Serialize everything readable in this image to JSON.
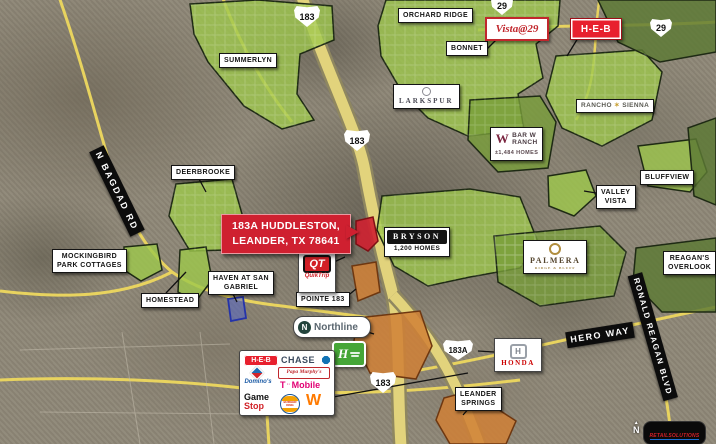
{
  "subject": {
    "line1": "183A HUDDLESTON,",
    "line2": "LEANDER, TX 78641"
  },
  "shields": {
    "s183_top": "183",
    "s183_mid": "183",
    "s183_bottom": "183",
    "s183a": "183A",
    "s29_left": "29",
    "s29_right": "29"
  },
  "communities": {
    "orchard_ridge": "ORCHARD RIDGE",
    "summerlyn": "SUMMERLYN",
    "bonnet": "BONNET",
    "larkspur": "LARKSPUR",
    "bar_w_ranch": {
      "monogram": "W",
      "l1": "BAR W",
      "l2": "RANCH",
      "homes": "±1,484 HOMES"
    },
    "rancho_sienna": {
      "l1": "RANCHO",
      "star": "✶",
      "l2": "SIENNA"
    },
    "deerbrooke": "DEERBROOKE",
    "valley_vista": {
      "l1": "VALLEY",
      "l2": "VISTA"
    },
    "bluffview": "BLUFFVIEW",
    "reagans_overlook": {
      "l1": "REAGAN'S",
      "l2": "OVERLOOK"
    },
    "palmera": {
      "name": "PALMERA",
      "sub": "RIDGE & BLUFF"
    },
    "bryson": {
      "name": "BRYSON",
      "homes": "1,200 HOMES"
    },
    "mockingbird": {
      "l1": "MOCKINGBIRD",
      "l2": "PARK COTTAGES"
    },
    "haven": {
      "l1": "HAVEN AT SAN",
      "l2": "GABRIEL"
    },
    "homestead": "HOMESTEAD",
    "pointe_183": "POINTE 183",
    "leander_springs": {
      "l1": "LEANDER",
      "l2": "SPRINGS"
    }
  },
  "roads": {
    "n_bagdad": "N BAGDAD RD",
    "hero_way": "HERO WAY",
    "ronald_reagan": "RONALD REAGAN BLVD"
  },
  "brands": {
    "vista29": "Vista@29",
    "heb_top": "H-E-B",
    "quiktrip": {
      "monogram": "QT",
      "name": "QuikTrip"
    },
    "northline": {
      "monogram": "N",
      "name": "Northline"
    },
    "honda": {
      "monogram": "H",
      "name": "HONDA"
    },
    "holiday_inn_express": {
      "monogram": "H"
    },
    "heb": "H-E-B",
    "chase": "CHASE",
    "dominos": "Domino's",
    "papa_murphys": "Papa Murphy's",
    "tmobile": {
      "t": "T",
      "name": "Mobile"
    },
    "gamestop": {
      "l1": "Game",
      "l2": "Stop"
    },
    "burger_king": {
      "l1": "BURGER",
      "l2": "KING"
    },
    "whataburger": "W"
  },
  "watermark": {
    "brand": "RETAILSOLUTIONS",
    "sub": "retailsolutions.us",
    "north": "N"
  },
  "colors": {
    "subject_red": "#cf2030",
    "community_green": "#9dc84b",
    "dark_green": "#5d7a34",
    "commercial_orange": "#d08036",
    "road_yellow": "#e2d37c",
    "heb_red": "#e8202e",
    "tmobile_magenta": "#e20074",
    "chase_blue": "#1173b5",
    "qt_red": "#d22027",
    "honda_red": "#cc0000",
    "hie_green": "#46a637"
  }
}
